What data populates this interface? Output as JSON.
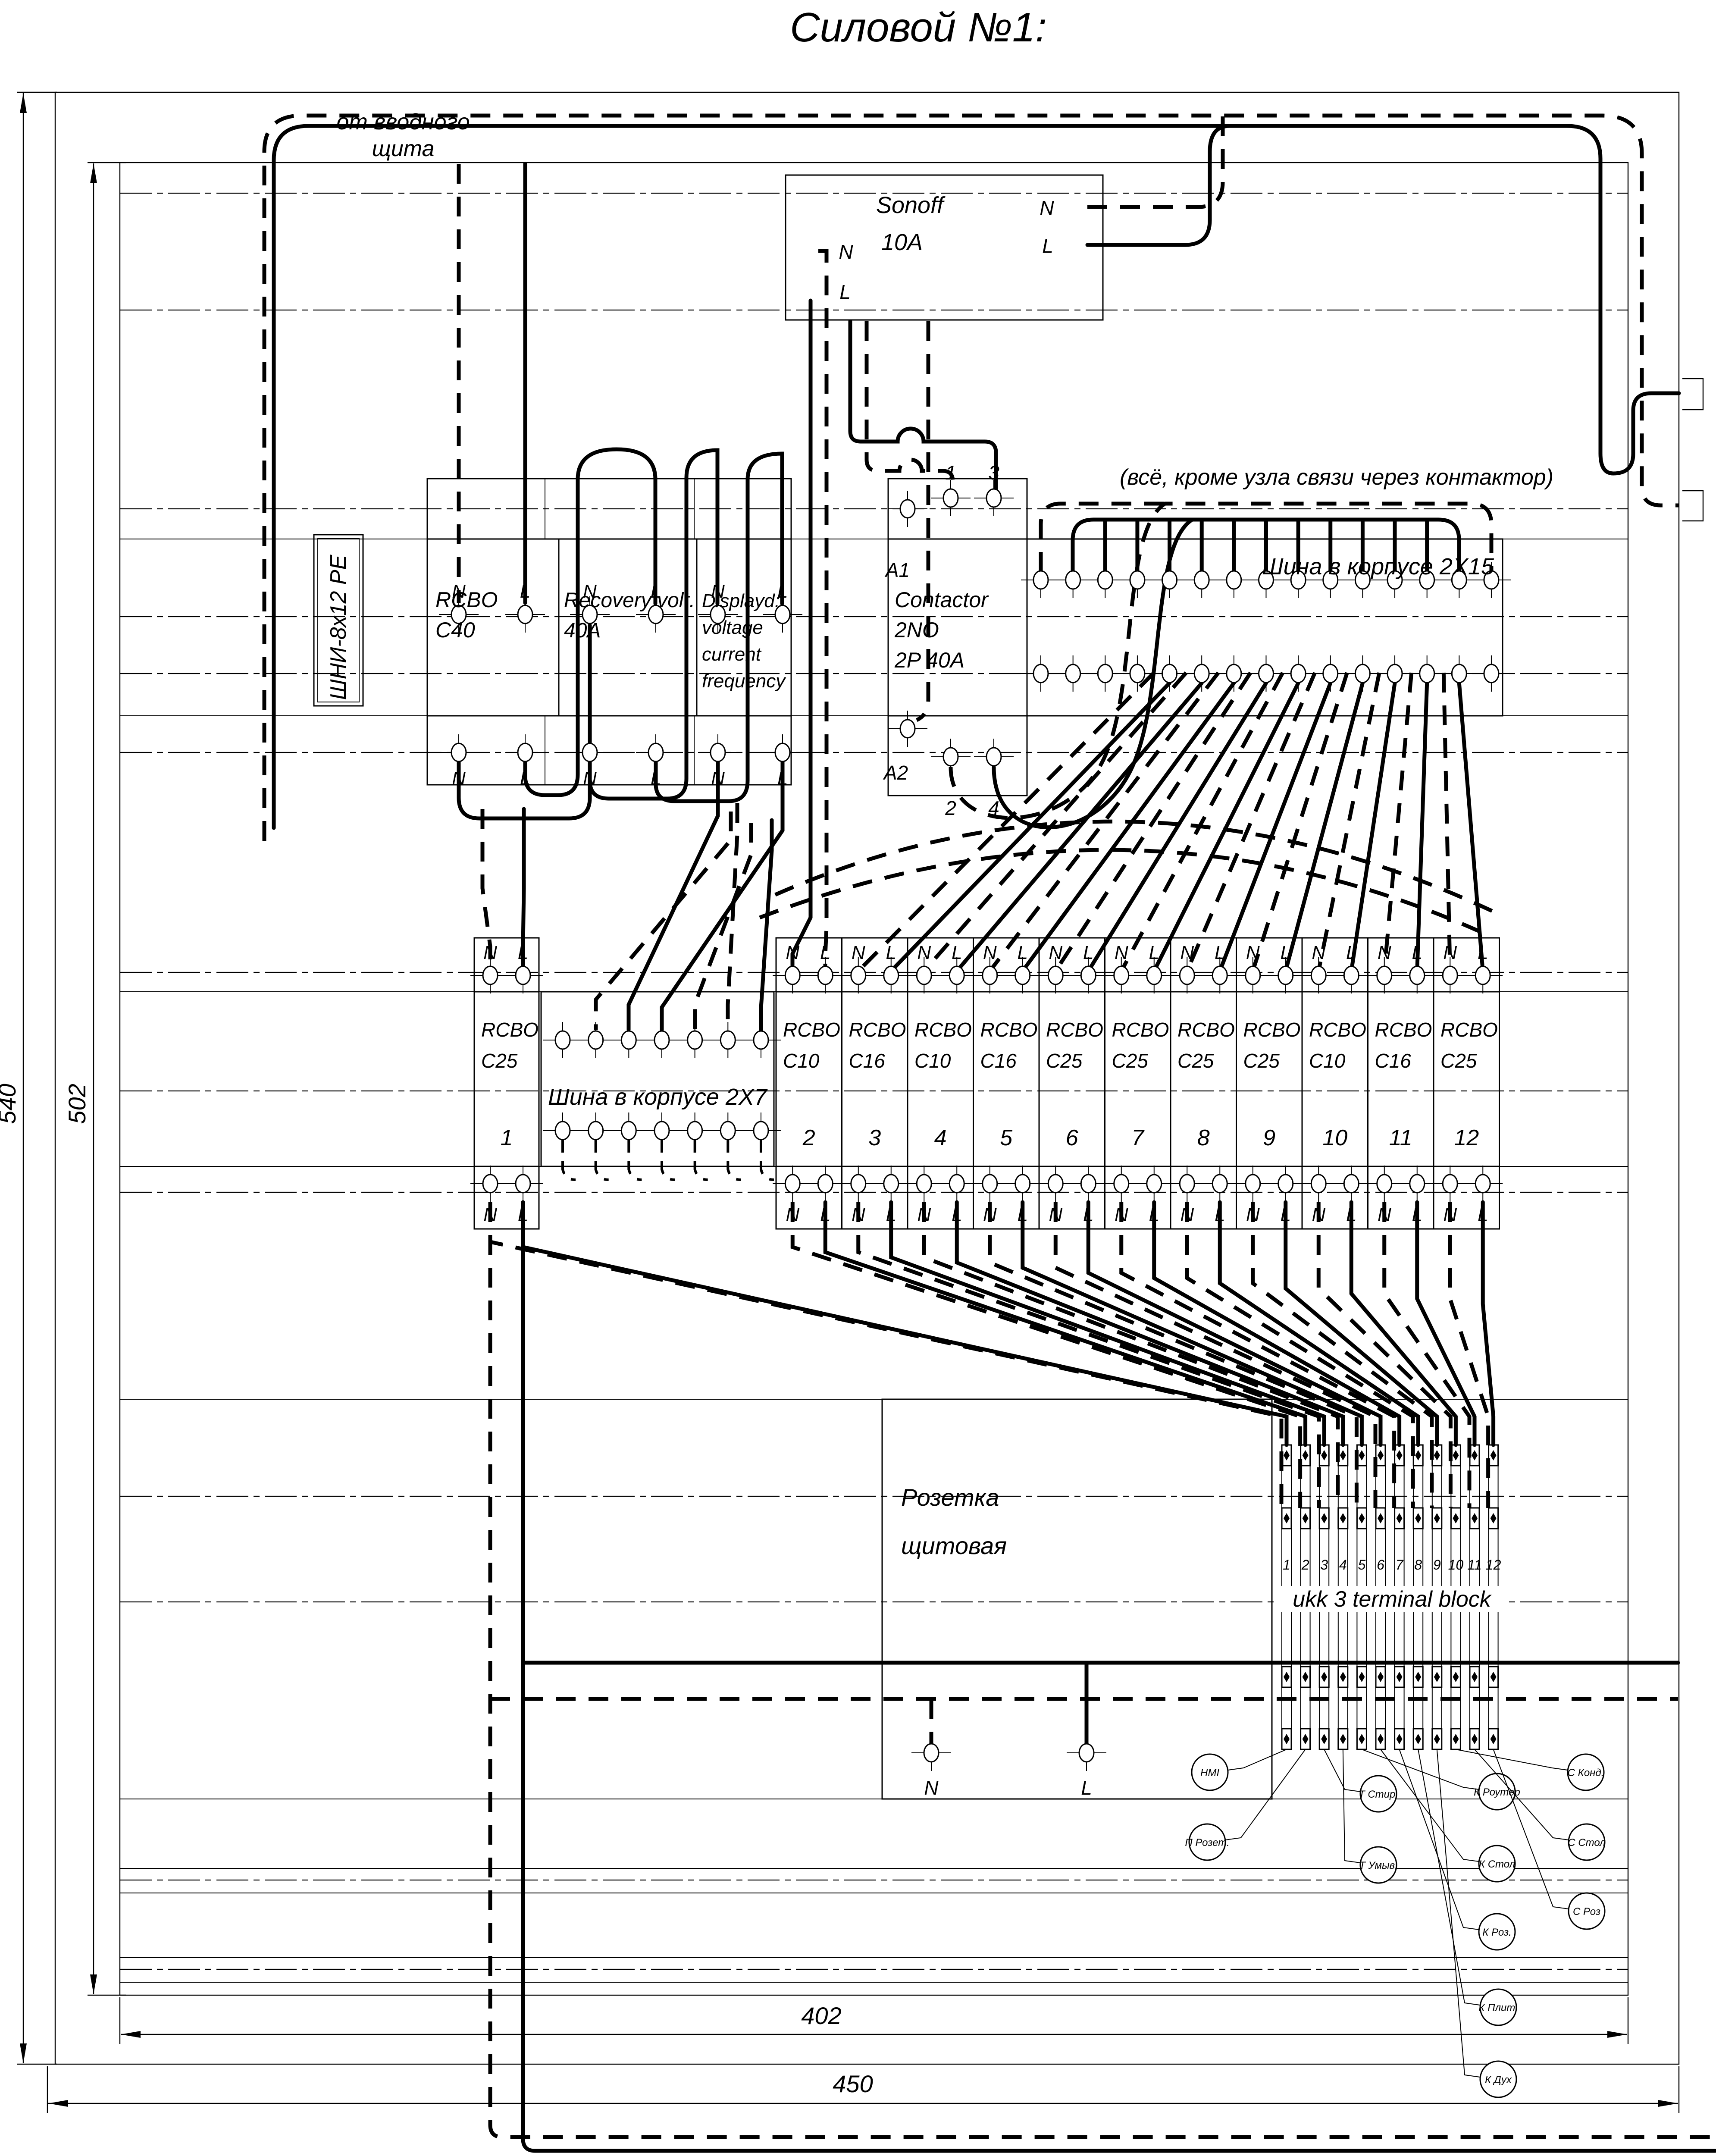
{
  "title": "Силовой №1:",
  "nl": [
    "N",
    "L"
  ],
  "labels": {
    "from_panel": [
      "от вводного",
      "щита"
    ],
    "note": "(всё, кроме узла связи через контактор)",
    "bus15": "Шина в корпусе 2X15",
    "bus7": "Шина в корпусе 2X7",
    "shni": "ШНИ-8х12 PE",
    "ukk": "ukk 3 terminal block",
    "socket": [
      "Розетка",
      "щитовая"
    ]
  },
  "sonoff": {
    "name": "Sonoff",
    "rating": "10A"
  },
  "row1": {
    "rcbo": [
      "RCBO",
      "C40"
    ],
    "recovery": [
      "Recovery volt.",
      "40A"
    ],
    "display": [
      "Displayd:",
      "voltage",
      "current",
      "frequency"
    ],
    "contactor": [
      "Contactor",
      "2NO",
      "2P 40A"
    ],
    "contactor_top": [
      "A1",
      "1",
      "3"
    ],
    "contactor_bottom": [
      "A2",
      "2",
      "4"
    ]
  },
  "breakers": [
    {
      "num": "1",
      "r1": "RCBO",
      "r2": "C25"
    },
    {
      "num": "2",
      "r1": "RCBO",
      "r2": "C10"
    },
    {
      "num": "3",
      "r1": "RCBO",
      "r2": "C16"
    },
    {
      "num": "4",
      "r1": "RCBO",
      "r2": "C10"
    },
    {
      "num": "5",
      "r1": "RCBO",
      "r2": "C16"
    },
    {
      "num": "6",
      "r1": "RCBO",
      "r2": "C25"
    },
    {
      "num": "7",
      "r1": "RCBO",
      "r2": "C25"
    },
    {
      "num": "8",
      "r1": "RCBO",
      "r2": "C25"
    },
    {
      "num": "9",
      "r1": "RCBO",
      "r2": "C25"
    },
    {
      "num": "10",
      "r1": "RCBO",
      "r2": "C10"
    },
    {
      "num": "11",
      "r1": "RCBO",
      "r2": "C16"
    },
    {
      "num": "12",
      "r1": "RCBO",
      "r2": "C25"
    }
  ],
  "ukk_numbers": [
    "1",
    "2",
    "3",
    "4",
    "5",
    "6",
    "7",
    "8",
    "9",
    "10",
    "11",
    "12"
  ],
  "circuits": [
    "HMI",
    "П Розет.",
    "Т Стир.",
    "Т Умыв.",
    "К Роутер",
    "К Стол",
    "К Роз.",
    "К Плит.",
    "К Дух",
    "С Конд.",
    "С Стол",
    "С Роз"
  ],
  "dimensions": {
    "height_outer": "540",
    "height_inner": "502",
    "width_inner": "402",
    "width_outer": "450"
  }
}
